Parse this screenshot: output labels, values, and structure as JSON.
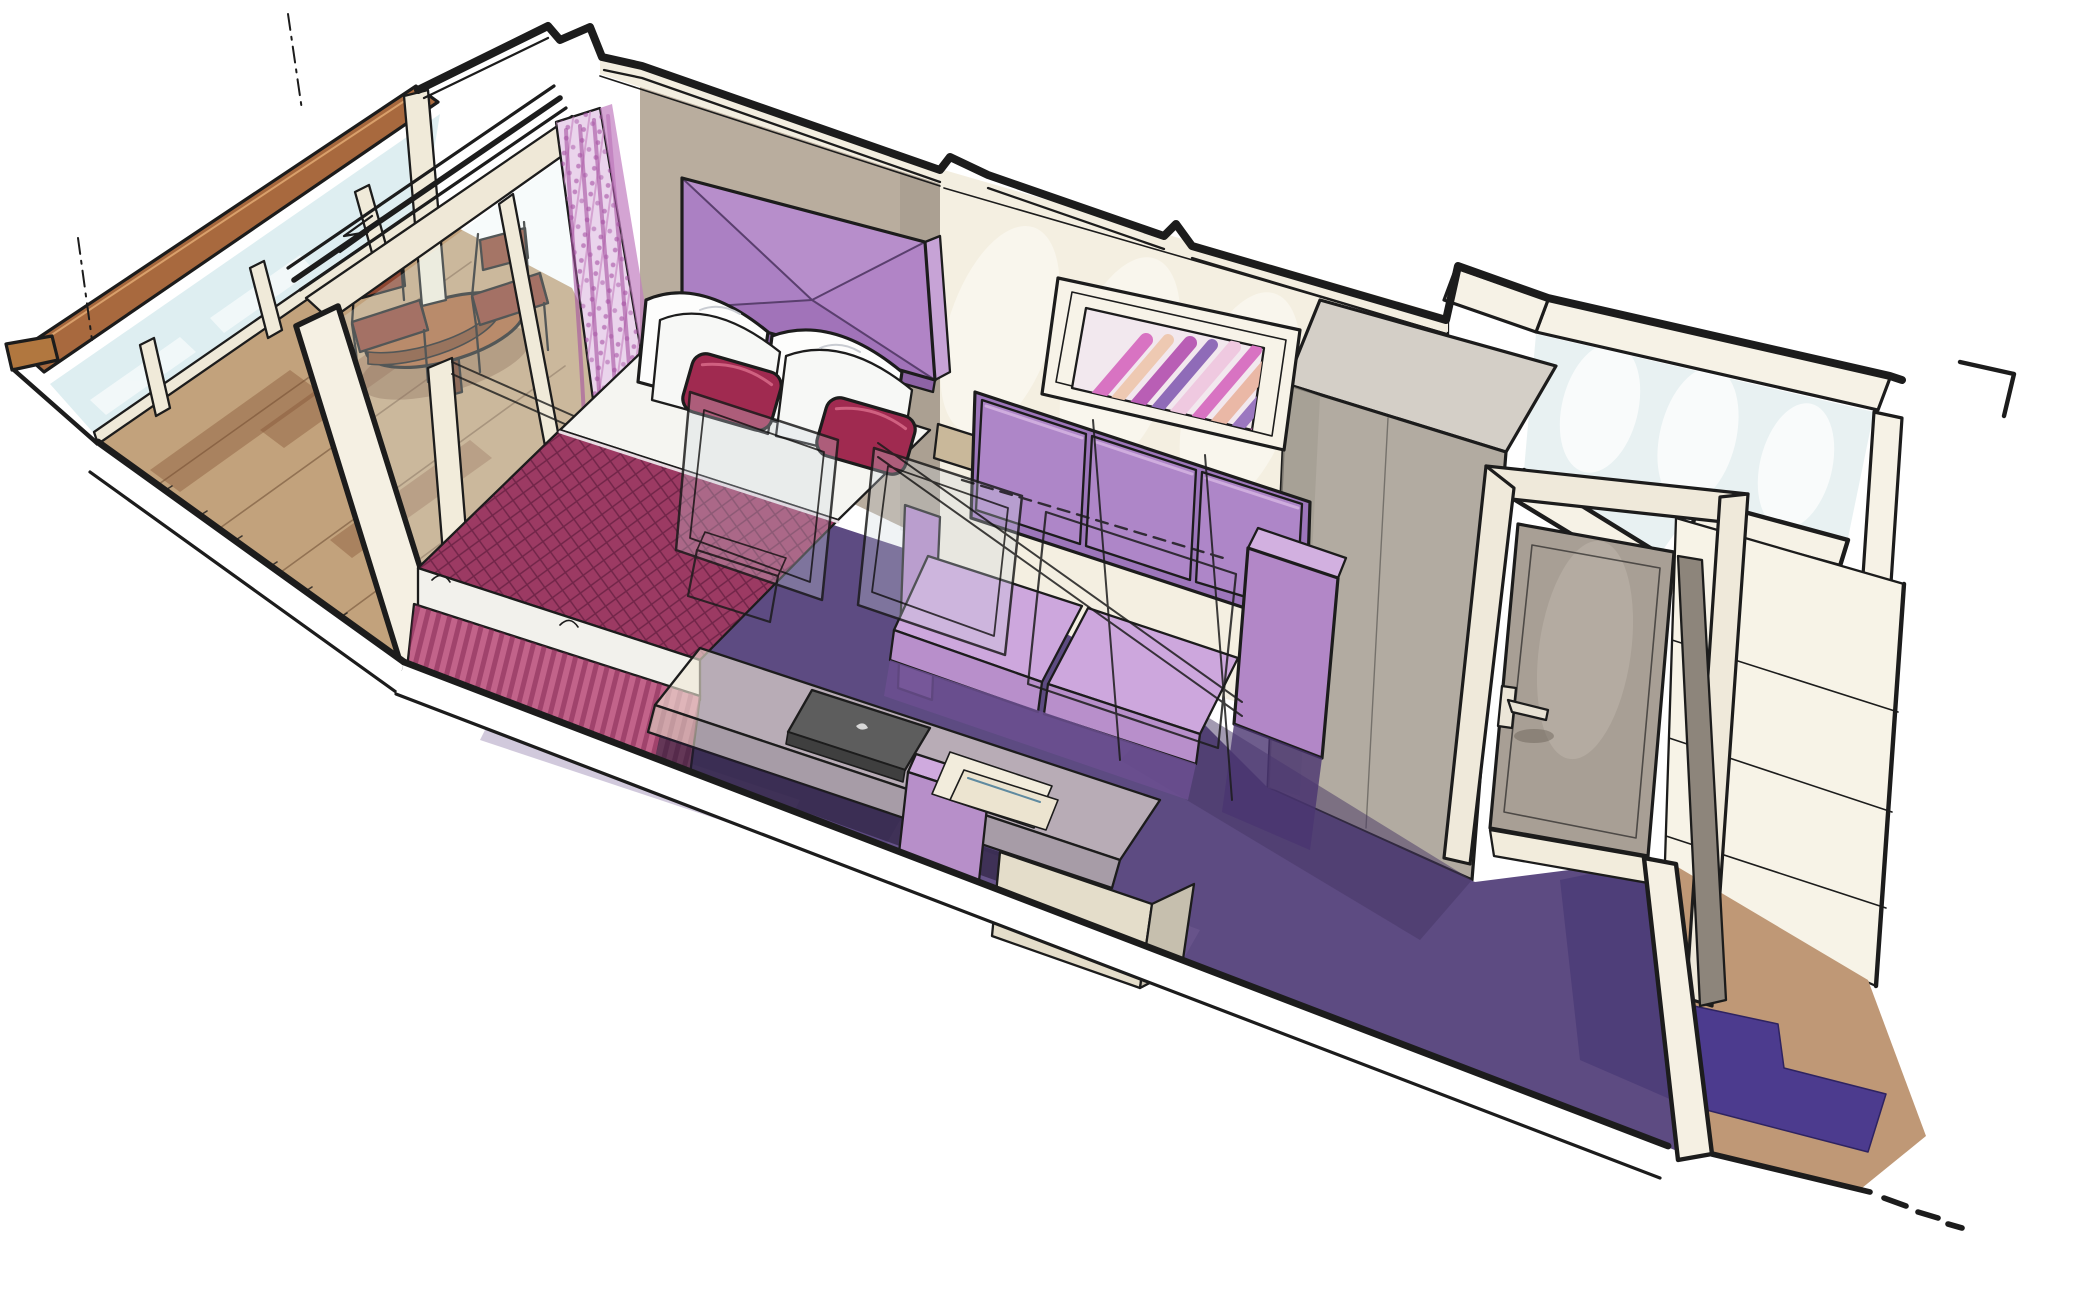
{
  "scene": {
    "title": "Cruise ship balcony stateroom — cutaway perspective sketch",
    "style": "hand-drawn marker and watercolor architectural illustration",
    "view": "cutaway seen from above the front-left corner",
    "areas": [
      "balcony",
      "sleeping area",
      "sofa lounge",
      "vanity desk",
      "wardrobe",
      "entrance",
      "bathroom",
      "corridor"
    ],
    "furniture": [
      "glass balustrade with wood cap",
      "balcony round table",
      "two balcony chairs",
      "sliding glass door with curtain",
      "double bed with upholstered headboard",
      "white pillows with accent cushions",
      "diagonal-stripe wall art",
      "three-seat lilac sofa",
      "translucent vanity desk with mirror",
      "laptop",
      "stool",
      "side cabinet",
      "tall wardrobe",
      "cabin entrance door with lever handle",
      "corridor runner mat"
    ]
  },
  "palette": {
    "ink": "#1c1c1c",
    "paper": "#ffffff",
    "wall_cream": "#f4efe1",
    "wall_taupe": "#b9ad9e",
    "wall_cut": "#f5f0e3",
    "carpet": "#5d4b82",
    "carpet_dark": "#241a35",
    "deck_wood": "#c2a27c",
    "cap_wood": "#a8693e",
    "table_wood": "#a96438",
    "chair_wood": "#8e4631",
    "balcony_glass": "#d9ecef",
    "curtain": "#ead4ec",
    "curtain_accent": "#b75eb2",
    "headboard_top": "#b78ecb",
    "headboard_left": "#ab80c3",
    "headboard_bottom": "#a173b9",
    "headboard_right": "#b184c6",
    "bedspread": "#9c3a63",
    "bed_skirt": "#c2638a",
    "pillow_accent": "#a02a50",
    "sofa_panel": "#9d76bb",
    "sofa_back": "#ae86c8",
    "sofa_seat": "#cda7dd",
    "sofa_arm": "#b287c7",
    "sofa_shadow": "#6b4f91",
    "desk_top": "#ece5d3",
    "cabinet": "#e4ddca",
    "stool": "#b78fc9",
    "laptop": "#5d5d5d",
    "wardrobe_front": "#b2aba1",
    "wardrobe_top": "#d4cfc7",
    "door_frame": "#efe9da",
    "door_panel": "#a89f95",
    "corridor_floor": "#bf9876",
    "runner": "#4c3b8e",
    "bathroom_interior": "#e8f1f2",
    "artwork_stripes": [
      "#d873c2",
      "#eec9b2",
      "#b95eb5",
      "#8f6bb8",
      "#efc9e0",
      "#d873c2",
      "#eab8a6",
      "#9b77c0",
      "#c45ab0"
    ]
  }
}
